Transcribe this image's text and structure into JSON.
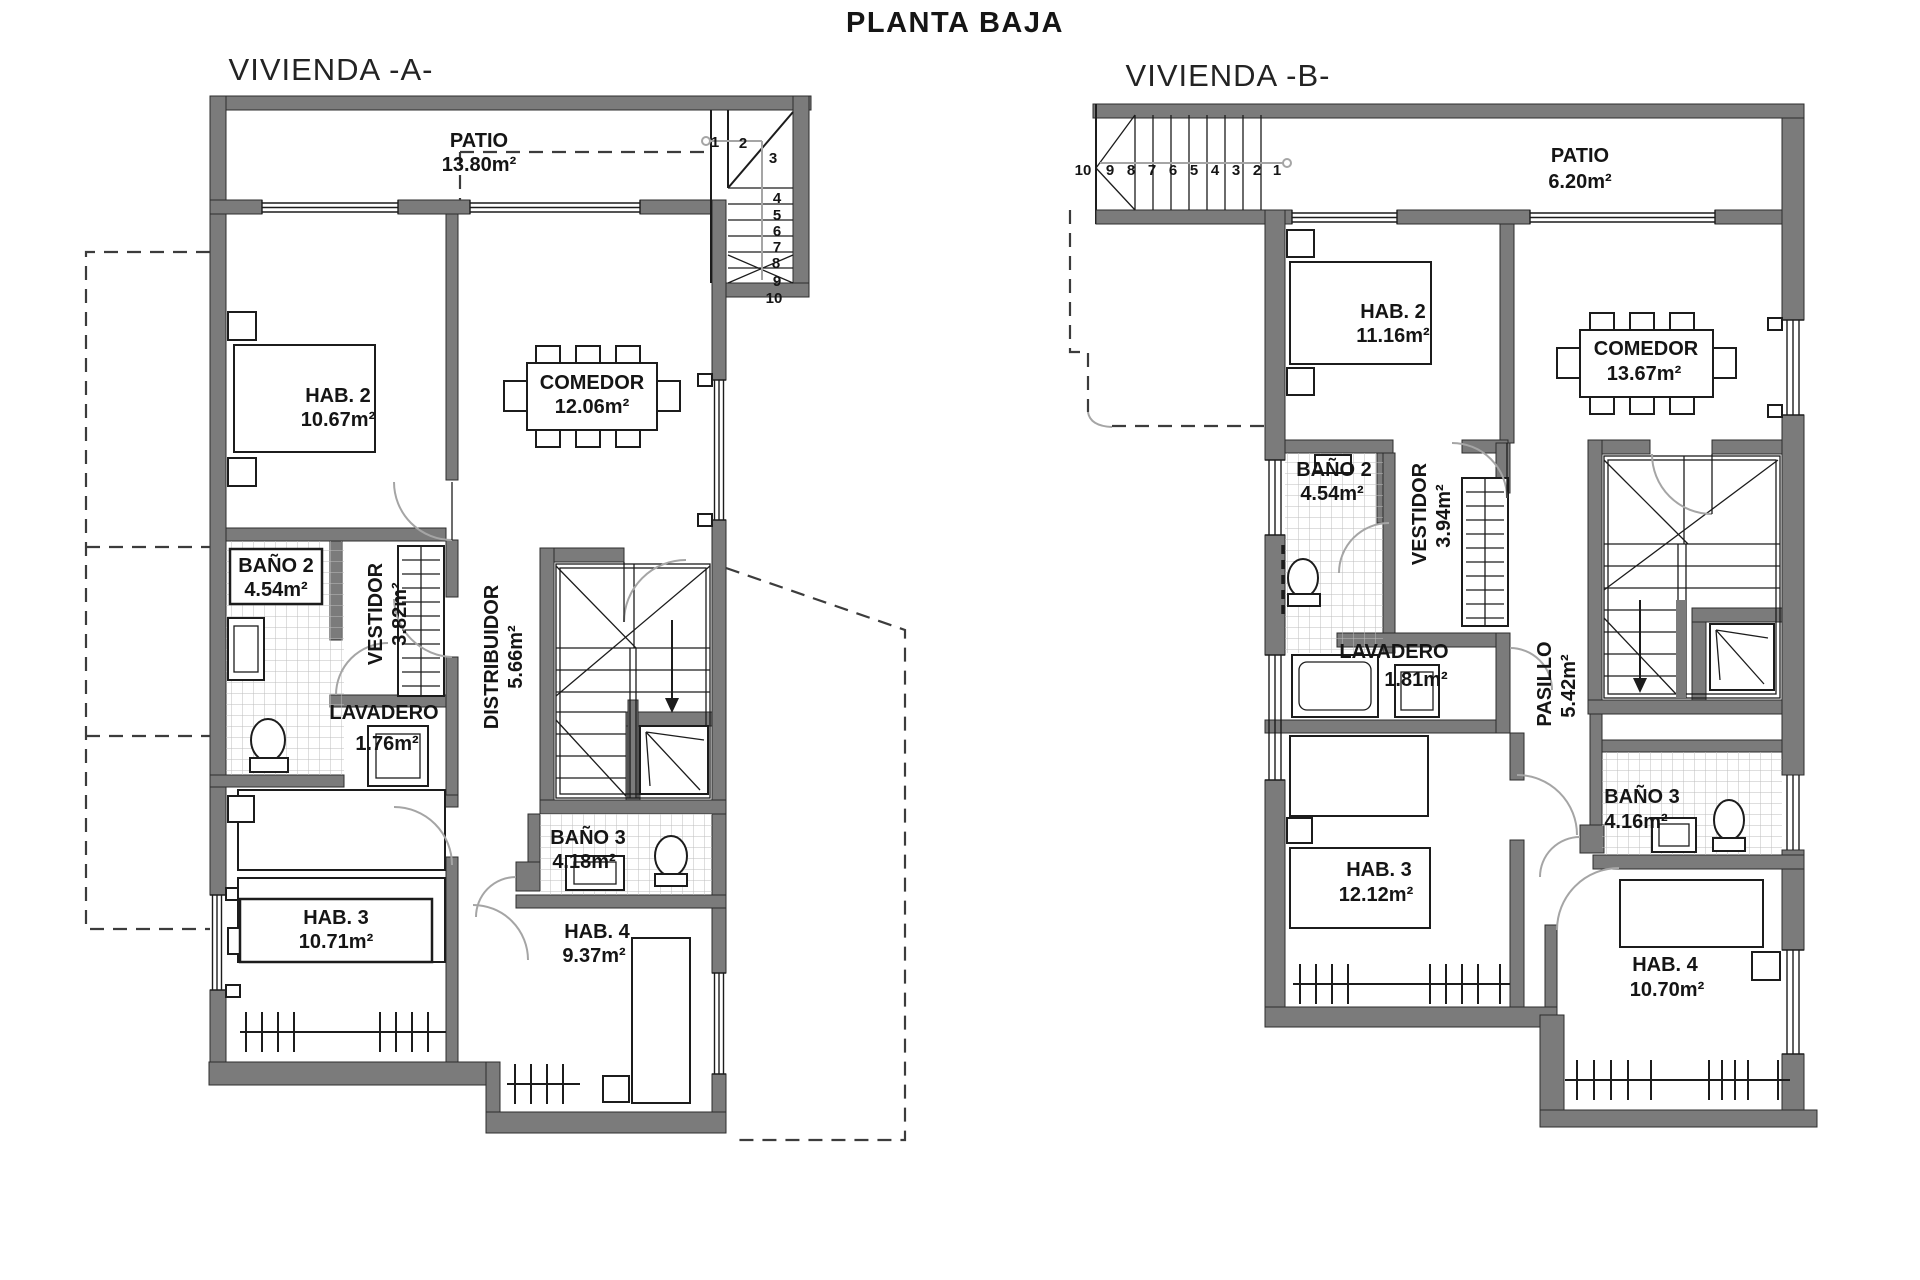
{
  "title": "PLANTA BAJA",
  "vivienda_a": {
    "label": "VIVIENDA -A-",
    "rooms": {
      "patio": {
        "name": "PATIO",
        "area": "13.80m²"
      },
      "hab2": {
        "name": "HAB. 2",
        "area": "10.67m²"
      },
      "comedor": {
        "name": "COMEDOR",
        "area": "12.06m²"
      },
      "bano2": {
        "name": "BAÑO 2",
        "area": "4.54m²"
      },
      "vestidor": {
        "name": "VESTIDOR",
        "area": "3.82m²"
      },
      "lavadero": {
        "name": "LAVADERO",
        "area": "1.76m²"
      },
      "distribuidor": {
        "name": "DISTRIBUIDOR",
        "area": "5.66m²"
      },
      "bano3": {
        "name": "BAÑO 3",
        "area": "4.18m²"
      },
      "hab3": {
        "name": "HAB. 3",
        "area": "10.71m²"
      },
      "hab4": {
        "name": "HAB. 4",
        "area": "9.37m²"
      }
    },
    "stairs": [
      "1",
      "2",
      "3",
      "4",
      "5",
      "6",
      "7",
      "8",
      "9",
      "10"
    ]
  },
  "vivienda_b": {
    "label": "VIVIENDA -B-",
    "rooms": {
      "patio": {
        "name": "PATIO",
        "area": "6.20m²"
      },
      "hab2": {
        "name": "HAB. 2",
        "area": "11.16m²"
      },
      "comedor": {
        "name": "COMEDOR",
        "area": "13.67m²"
      },
      "bano2": {
        "name": "BAÑO 2",
        "area": "4.54m²"
      },
      "vestidor": {
        "name": "VESTIDOR",
        "area": "3.94m²"
      },
      "lavadero": {
        "name": "LAVADERO",
        "area": "1.81m²"
      },
      "pasillo": {
        "name": "PASILLO",
        "area": "5.42m²"
      },
      "bano3": {
        "name": "BAÑO 3",
        "area": "4.16m²"
      },
      "hab3": {
        "name": "HAB. 3",
        "area": "12.12m²"
      },
      "hab4": {
        "name": "HAB. 4",
        "area": "10.70m²"
      }
    },
    "stairs": [
      "10",
      "9",
      "8",
      "7",
      "6",
      "5",
      "4",
      "3",
      "2",
      "1"
    ]
  }
}
